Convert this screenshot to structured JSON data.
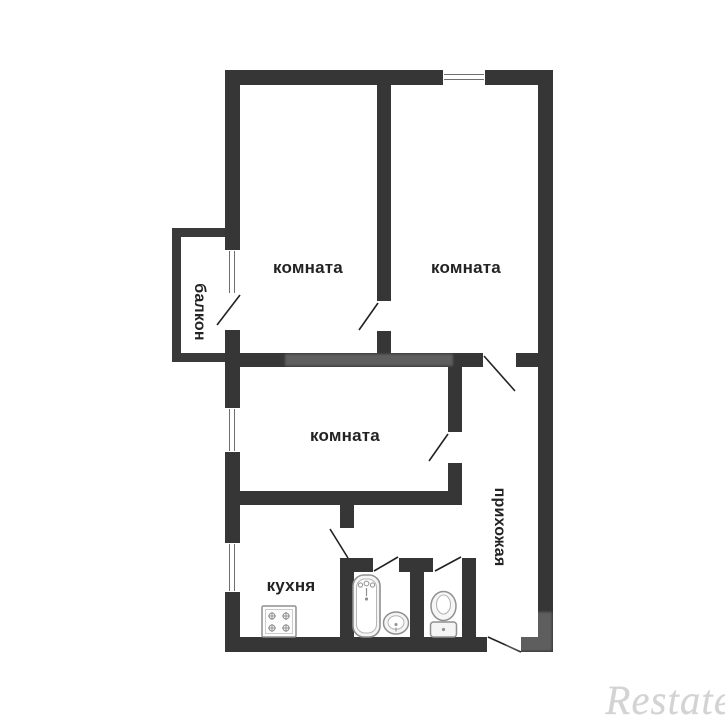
{
  "plan": {
    "labels": {
      "room_top_left": "комната",
      "room_top_right": "комната",
      "room_middle": "комната",
      "kitchen": "кухня",
      "balcony": "балкон",
      "hallway": "прихожая"
    },
    "icons": [
      {
        "name": "window-icon",
        "count": 4
      },
      {
        "name": "door-swing-icon",
        "count": 8
      },
      {
        "name": "stove-icon"
      },
      {
        "name": "bathtub-icon"
      },
      {
        "name": "sink-icon"
      },
      {
        "name": "toilet-icon"
      }
    ],
    "colors": {
      "wall": "#363636",
      "background": "#ffffff",
      "room_fill": "#ffffff",
      "label_text": "#232323",
      "fixture_stroke": "#909090",
      "watermark": "#d3d3d3"
    }
  },
  "watermark": {
    "text": "Restate"
  }
}
